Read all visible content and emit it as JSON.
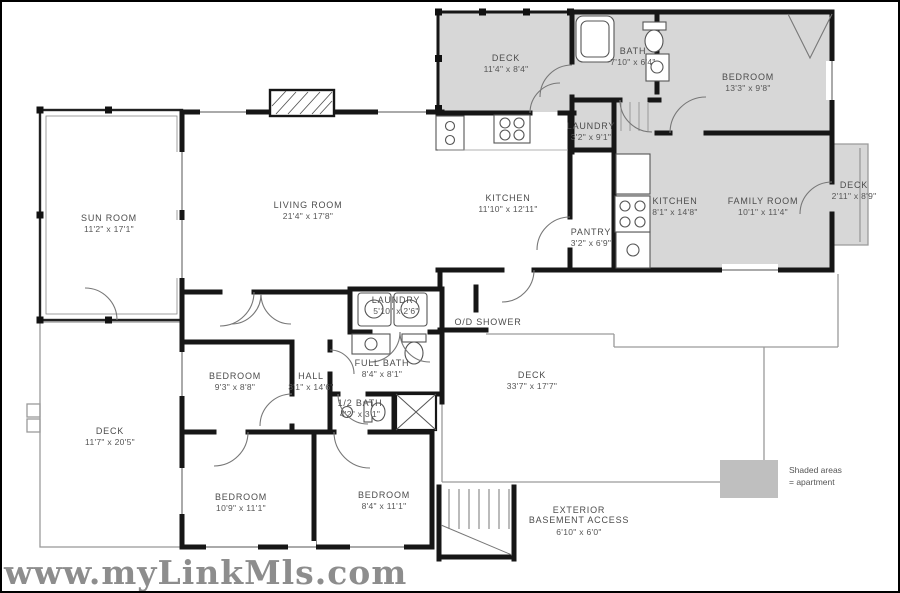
{
  "watermark": "www.myLinkMls.com",
  "legend": {
    "line1": "Shaded areas",
    "line2": "= apartment"
  },
  "colors": {
    "apartment_shade": "#d7d7d7",
    "legend_swatch": "#bfbfbf",
    "wall": "#161616"
  },
  "rooms": {
    "deck_apartment": {
      "name": "DECK",
      "dims": "11'4\" x 8'4\""
    },
    "bath_apartment": {
      "name": "BATH",
      "dims": "7'10\" x 6'4\""
    },
    "bedroom_apartment": {
      "name": "BEDROOM",
      "dims": "13'3\" x 9'8\""
    },
    "laundry_apartment": {
      "name": "LAUNDRY",
      "dims": "3'2\" x 9'1\""
    },
    "kitchen_apartment": {
      "name": "KITCHEN",
      "dims": "8'1\" x 14'8\""
    },
    "family_room": {
      "name": "FAMILY ROOM",
      "dims": "10'1\" x 11'4\""
    },
    "deck_right": {
      "name": "DECK",
      "dims": "2'11\" x 8'9\""
    },
    "sun_room": {
      "name": "SUN ROOM",
      "dims": "11'2\" x 17'1\""
    },
    "living_room": {
      "name": "LIVING ROOM",
      "dims": "21'4\" x 17'8\""
    },
    "kitchen_main": {
      "name": "KITCHEN",
      "dims": "11'10\" x 12'11\""
    },
    "pantry": {
      "name": "PANTRY",
      "dims": "3'2\" x 6'9\""
    },
    "laundry_main": {
      "name": "LAUNDRY",
      "dims": "5'10\" x 2'6\""
    },
    "od_shower": {
      "name": "O/D SHOWER"
    },
    "full_bath": {
      "name": "FULL BATH",
      "dims": "8'4\" x 8'1\""
    },
    "bedroom_middle": {
      "name": "BEDROOM",
      "dims": "9'3\" x 8'8\""
    },
    "hall": {
      "name": "HALL",
      "dims": "3'1\" x 14'6\""
    },
    "half_bath": {
      "name": "1/2 BATH",
      "dims": "4'2\" x 3'1\""
    },
    "deck_main": {
      "name": "DECK",
      "dims": "33'7\" x 17'7\""
    },
    "deck_left": {
      "name": "DECK",
      "dims": "11'7\" x 20'5\""
    },
    "bedroom_bottom_left": {
      "name": "BEDROOM",
      "dims": "10'9\" x 11'1\""
    },
    "bedroom_bottom_mid": {
      "name": "BEDROOM",
      "dims": "8'4\" x 11'1\""
    },
    "basement_access": {
      "line1": "EXTERIOR",
      "line2": "BASEMENT ACCESS",
      "dims": "6'10\" x 6'0\""
    }
  }
}
